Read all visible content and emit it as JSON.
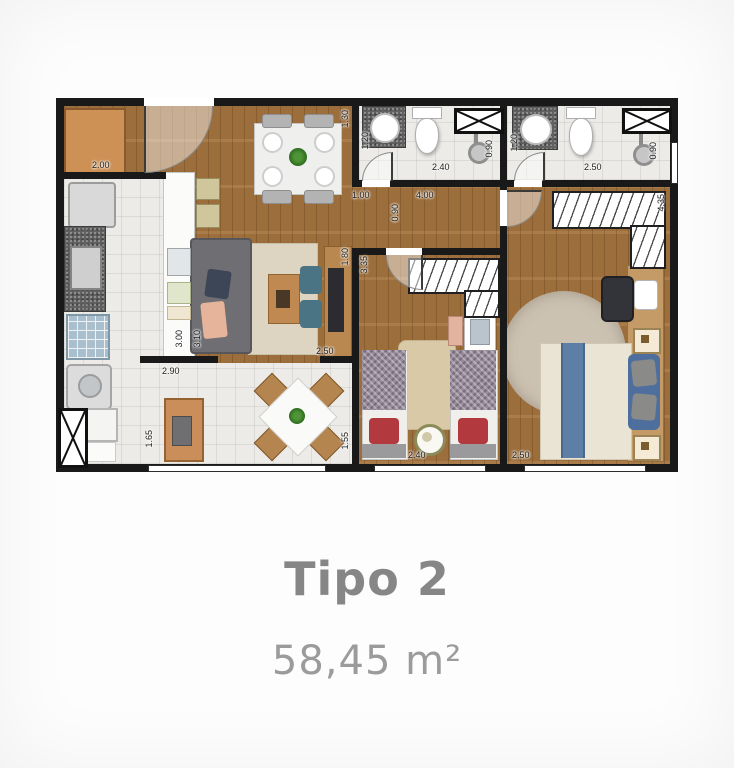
{
  "caption": {
    "title": "Tipo 2",
    "area": "58,45 m²"
  },
  "plan": {
    "dims": {
      "kitchen_width": "2.00",
      "entry_right": "1.30",
      "bath1_door": "1.20",
      "bath1_width": "2.40",
      "bath1_shower": "0.90",
      "hall_left": "1.00",
      "hall_width": "4.00",
      "hall_door": "0.90",
      "bath2_door": "1.20",
      "bath2_width": "2.50",
      "bath2_shower": "0.90",
      "master_depth": "4.35",
      "tv_wall": "1.80",
      "bed2_depth": "3.35",
      "kitchen_depth": "3.00",
      "living_depth": "3.10",
      "living_width": "2.50",
      "dining_width": "2.90",
      "dining_left": "1.65",
      "dining_right": "1.55",
      "bed2_width": "2.40",
      "master_width": "2.50"
    },
    "colors": {
      "wall": "#191919",
      "wood_floor": "#a4743f",
      "tile_floor": "#ecebe7",
      "wood_furniture": "#c08952",
      "sofa_gray": "#6f6f73",
      "accent_teal": "#4a7383",
      "bed_cream": "#eae4d4",
      "bed_runner_blue": "#5d7fa5",
      "pillow_red": "#b23a3f",
      "caption_text": "#868686"
    }
  }
}
